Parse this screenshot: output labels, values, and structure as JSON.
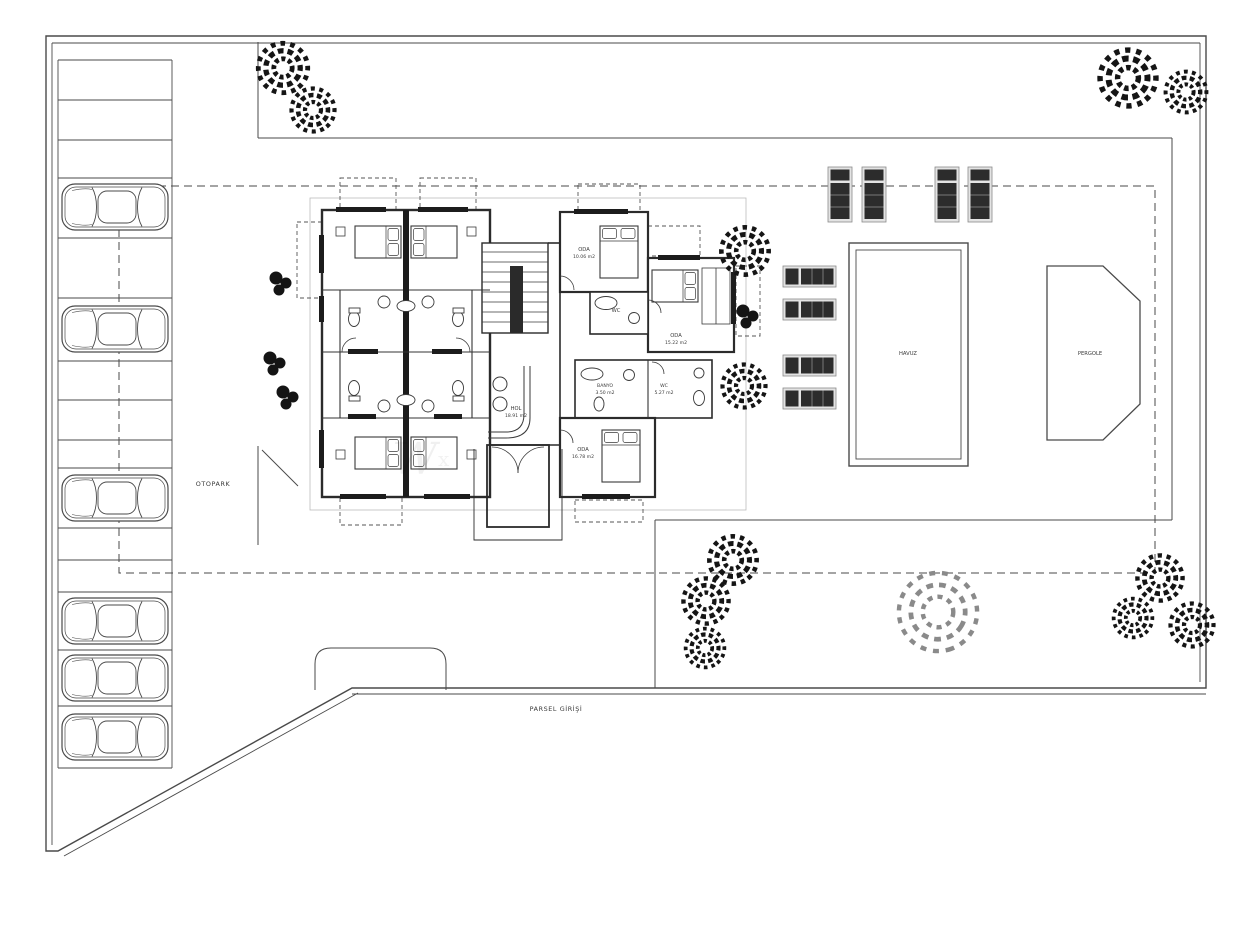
{
  "site": {
    "otopark": "OTOPARK",
    "havuz": "HAVUZ",
    "pergole": "PERGOLE",
    "parsel_girisi": "PARSEL GİRİŞİ",
    "watermark": "W",
    "watermark2": "x"
  },
  "rooms": {
    "oda_top": {
      "name": "ODA",
      "area": "10.06 m2"
    },
    "oda_right": {
      "name": "ODA",
      "area": "15.22 m2"
    },
    "oda_bottom": {
      "name": "ODA",
      "area": "16.78 m2"
    },
    "hol": {
      "name": "HOL",
      "area": "18.91 m2"
    },
    "banyo": {
      "name": "BANYO",
      "area": "3.50 m2"
    },
    "wc_right": {
      "name": "WC",
      "area": "5.27 m2"
    },
    "wc_top": {
      "name": "WC",
      "area": ""
    }
  },
  "counts": {
    "cars": 6,
    "parking_stalls": 15,
    "sun_loungers": 8,
    "trees": 15,
    "bush_clusters": 4
  },
  "colors": {
    "background": "#ffffff",
    "line": "#4a4a4a",
    "wall": "#2b2b2b",
    "dark_fill": "#1c1c1c",
    "lounger_pad": "#2c2c2c",
    "tree_dark": "#151515",
    "tree_light": "#8a8a8a"
  }
}
